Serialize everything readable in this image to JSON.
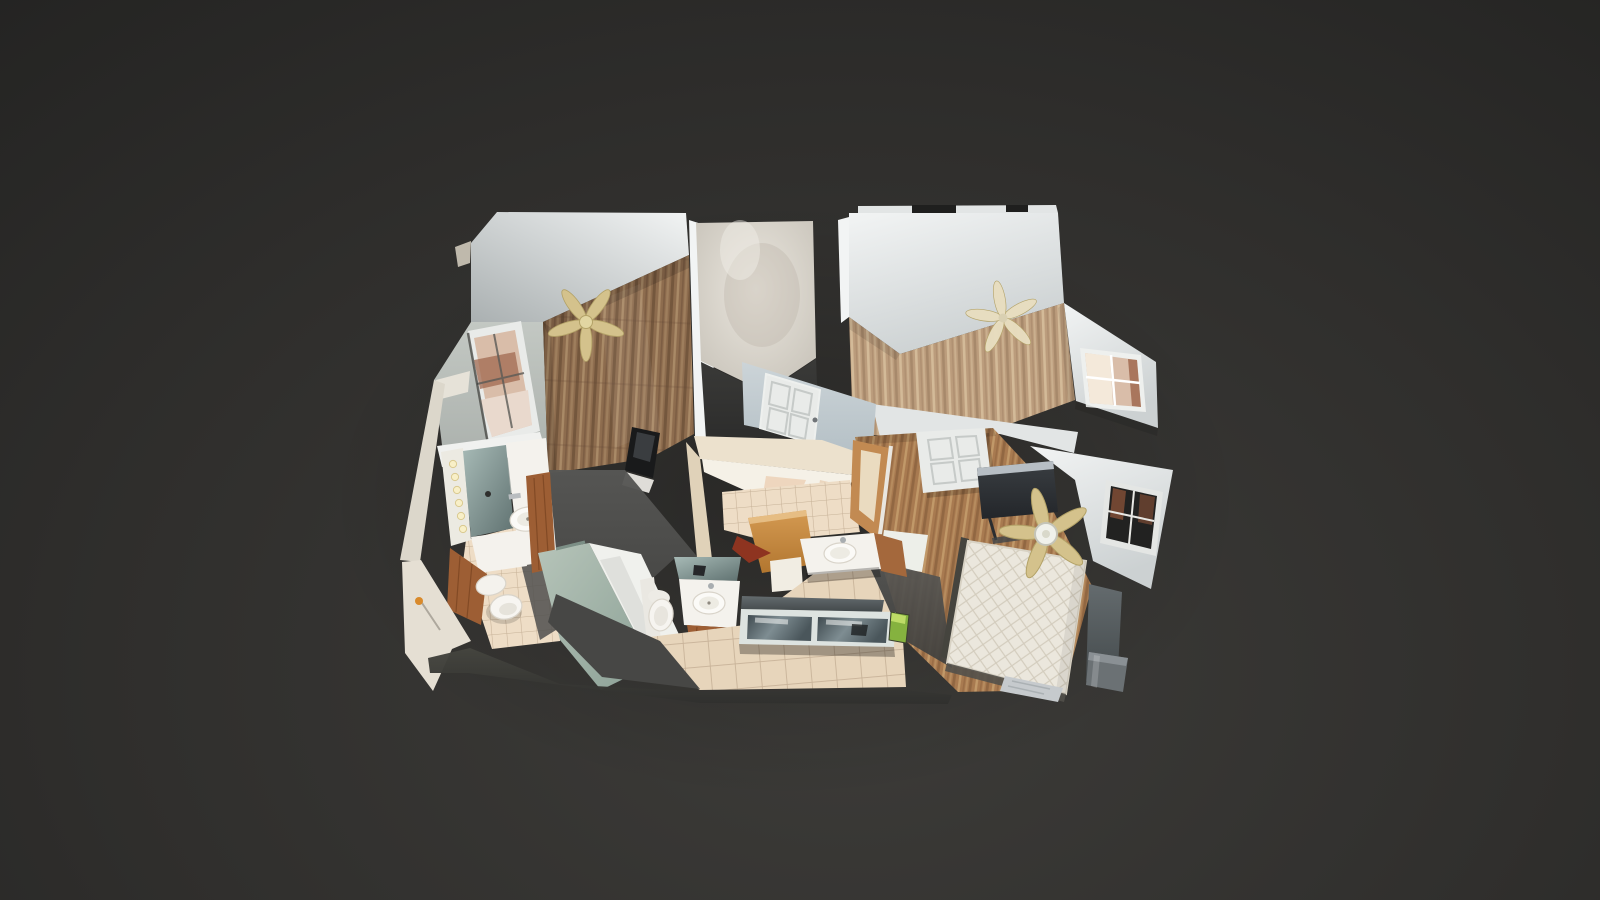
{
  "canvas": {
    "width": 1600,
    "height": 900
  },
  "scene": {
    "name": "3d-dollhouse-view-residential-scan",
    "view": "top-down-oblique-dollhouse",
    "rooms": [
      {
        "id": "bedroom-left",
        "features": [
          "ceiling-fan",
          "window-with-brick-view",
          "wood-floor",
          "laptop-on-floor"
        ]
      },
      {
        "id": "closet-nook",
        "features": [
          "marbled-walls",
          "unscanned-dark-floor"
        ]
      },
      {
        "id": "bedroom-right",
        "features": [
          "ceiling-fan",
          "bay-window",
          "wood-floor"
        ]
      },
      {
        "id": "hallway",
        "features": [
          "white-paneled-door"
        ]
      },
      {
        "id": "bathroom-left",
        "features": [
          "lit-vanity-mirror",
          "sink",
          "toilet",
          "wood-cabinets",
          "tile-floor"
        ]
      },
      {
        "id": "shower-room",
        "features": [
          "sage-walls",
          "white-tub"
        ]
      },
      {
        "id": "bathroom-middle",
        "features": [
          "vanity-mirror",
          "sink",
          "toilet",
          "open-wood-door",
          "tile-floor"
        ]
      },
      {
        "id": "kitchen-area",
        "features": [
          "sink",
          "mirrored-counter",
          "large-tile-floor",
          "green-item"
        ]
      },
      {
        "id": "bedroom-bottom",
        "features": [
          "quilted-mattress",
          "ceiling-fan",
          "tv",
          "door-panel-on-floor",
          "window",
          "trash-can",
          "side-table"
        ]
      }
    ]
  },
  "colors": {
    "bg_edge": "#1f1f1e",
    "bg_mid": "#302f2d",
    "bg_glow": "#3d3c39",
    "wall_bright": "#f2f4f4",
    "wall_light": "#e2e5e5",
    "wall_mid": "#ccd1d2",
    "wall_shade": "#aab0b1",
    "wall_green_l": "#c3c8c3",
    "wall_green_d": "#a0a6a2",
    "marble_light": "#eae6de",
    "marble_shade": "#c3beb4",
    "wood1_base": "#8d6c4e",
    "wood1_light": "#b3946f",
    "wood1_dark": "#5f4530",
    "wood2_base": "#bb9c7c",
    "wood2_light": "#dac29f",
    "wood2_dark": "#94755a",
    "wood3_base": "#a87a50",
    "wood3_light": "#c9a271",
    "wood3_dark": "#7a5433",
    "khaki": "#d4c28c",
    "khaki_dark": "#b3a267",
    "cream_blade": "#e8dec0",
    "tile_small": "#eeddc6",
    "tile_big": "#e7d5bb",
    "grout": "#c7b298",
    "fixture_white": "#f4f2ed",
    "fixture_shade": "#d9d4ca",
    "cabinet": "#9d5e34",
    "cabinet_dark": "#76421f",
    "sage_l": "#b6c4b9",
    "sage_d": "#8ba095",
    "mirror_l": "#a7bab6",
    "mirror_d": "#5f7170",
    "door_white": "#e9ebe9",
    "door_shade": "#c6cac8",
    "wall_blue_l": "#ccd4d8",
    "wall_blue_d": "#b0bcc2",
    "dark_floor_l": "#3a3a38",
    "dark_floor_d": "#2d2d2c",
    "gray_blob_l": "#575755",
    "gray_blob_d": "#3e3e3c",
    "slab_gray": "#5d6164",
    "mattress": "#ebe7dd",
    "mattress_line": "#d3ccbd",
    "frame_dark": "#45443e",
    "tv_l": "#3a3e42",
    "tv_d": "#23262a",
    "tv_silver": "#b7bec4",
    "brick": "#a06a50",
    "brick_light": "#d9bda9",
    "brick_dark": "#7a4a34",
    "trash": "#6b7174",
    "cream_wall": "#ece1cd",
    "cream_shade": "#e0d2b9",
    "orange_l": "#d49a52",
    "orange_d": "#b2762f",
    "red_edge": "#8e3420",
    "glow": "#f8efc7",
    "green_item": "#85b23f",
    "sheet": "#c6cacd",
    "band_l": "#45453f",
    "band_d": "#30302e"
  }
}
